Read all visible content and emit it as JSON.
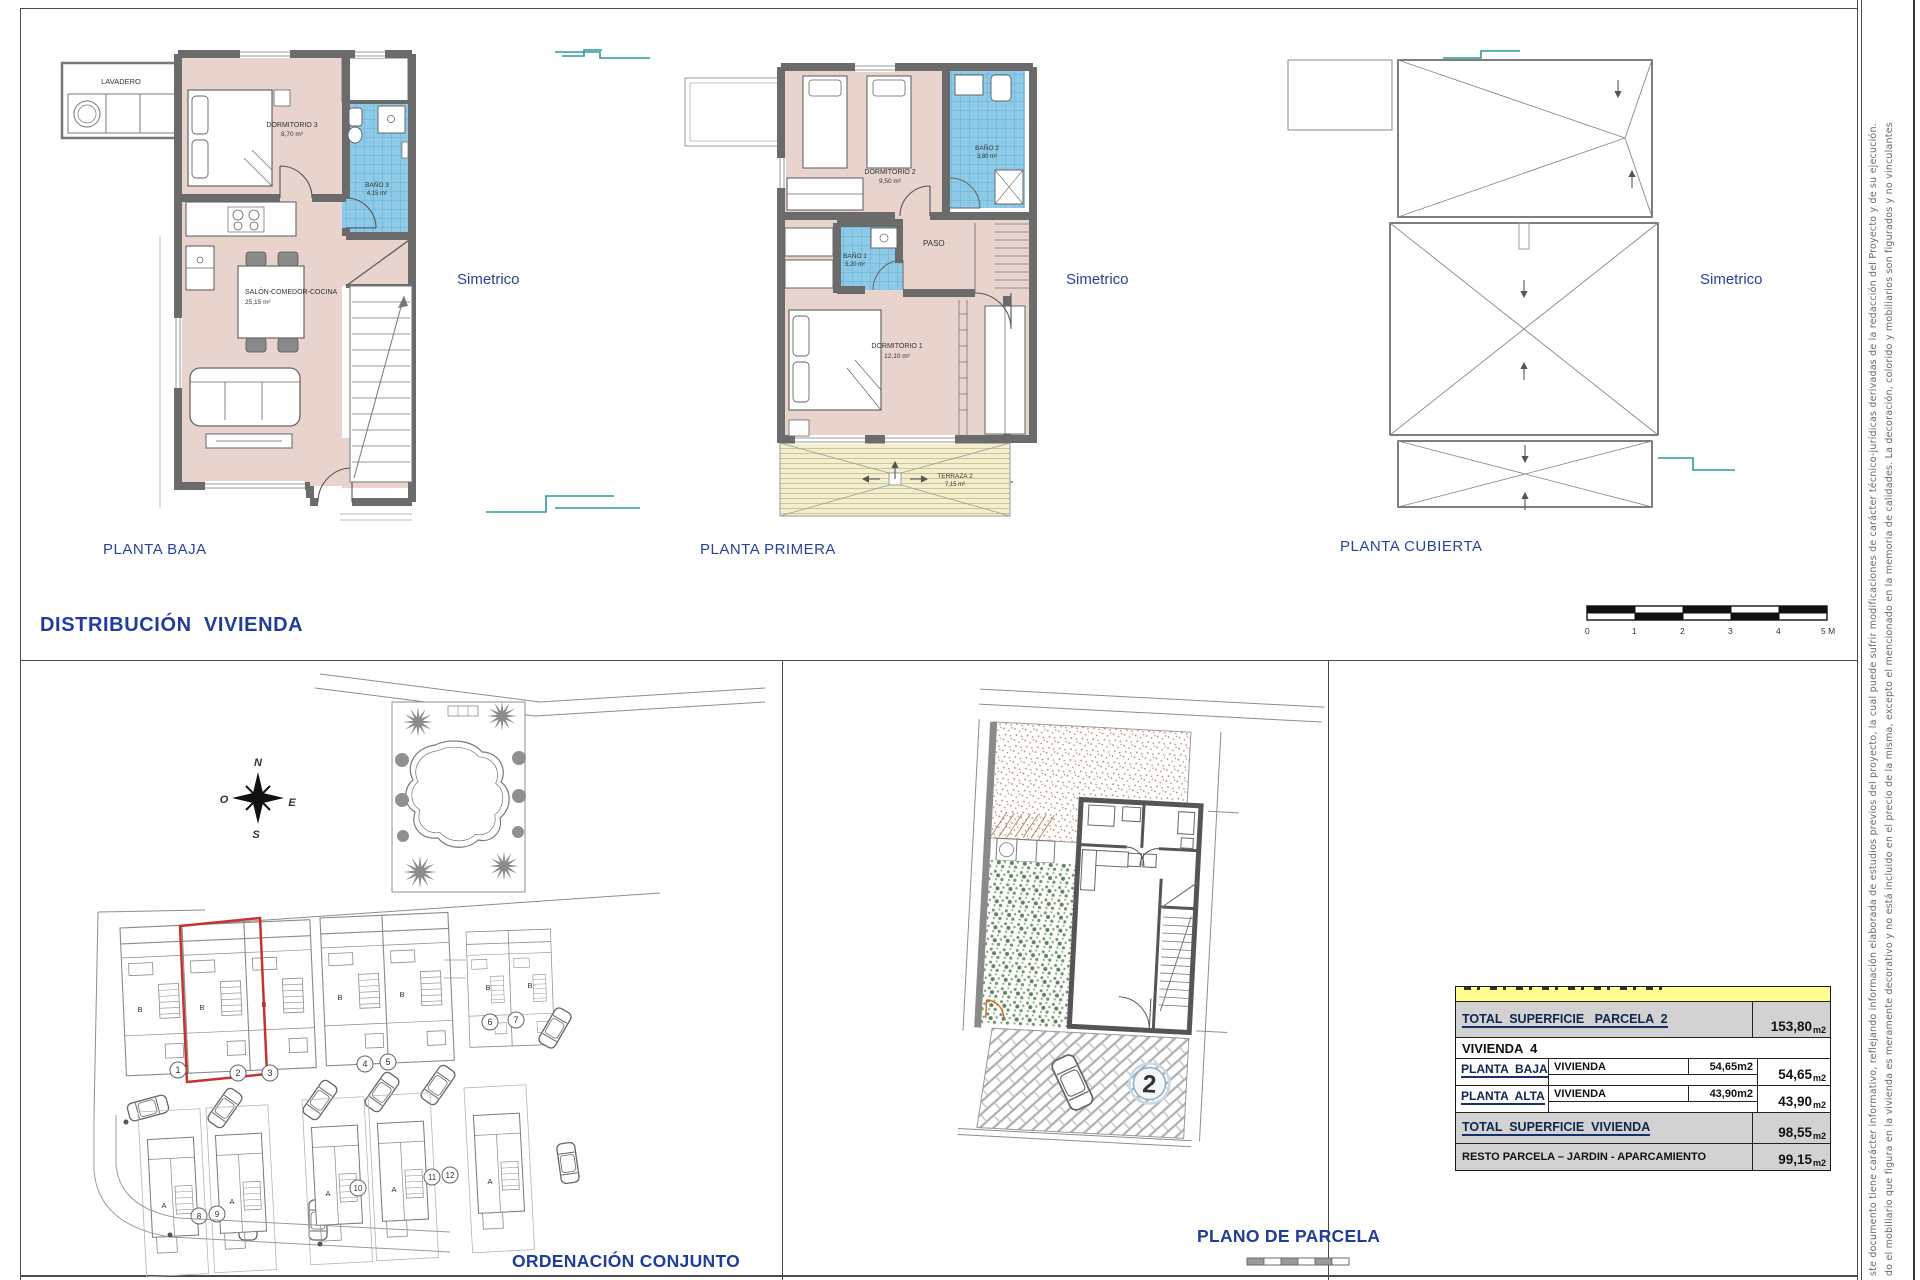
{
  "sheet_title": "DISTRIBUCIÓN  VIVIENDA",
  "plans": {
    "baja": {
      "title": "PLANTA BAJA",
      "simetrico": "Simetrico",
      "lavadero": "LAVADERO",
      "dormitorio3_name": "DORMITORIO 3",
      "dormitorio3_area": "8,70 m²",
      "bano3_name": "BAÑO 3",
      "bano3_area": "4,15 m²",
      "salon_name": "SALÓN-COMEDOR-COCINA",
      "salon_area": "25,15 m²"
    },
    "primera": {
      "title": "PLANTA PRIMERA",
      "simetrico": "Simetrico",
      "dormitorio2_name": "DORMITORIO 2",
      "dormitorio2_area": "9,50 m²",
      "bano2_name": "BAÑO 2",
      "bano2_area": "3,80 m²",
      "bano1_name": "BAÑO 1",
      "bano1_area": "3,20 m²",
      "paso": "PASO",
      "dormitorio1_name": "DORMITORIO 1",
      "dormitorio1_area": "12,10 m²",
      "terraza_name": "TERRAZA 2",
      "terraza_area": "7,15 m²"
    },
    "cubierta": {
      "title": "PLANTA CUBIERTA",
      "simetrico": "Simetrico"
    }
  },
  "scale_bar": {
    "ticks": [
      "0",
      "1",
      "2",
      "3",
      "4",
      "5 M"
    ]
  },
  "site_plan": {
    "title": "ORDENACIÓN CONJUNTO",
    "compass": {
      "n": "N",
      "e": "E",
      "s": "S",
      "w": "O"
    },
    "plots_upper": [
      "1",
      "2",
      "3",
      "4",
      "5",
      "6",
      "7"
    ],
    "plots_lower": [
      "8",
      "9",
      "10",
      "11",
      "12"
    ],
    "unit_b": "B",
    "unit_a": "A"
  },
  "parcel_plan": {
    "title": "PLANO DE PARCELA",
    "parcel_number": "2"
  },
  "area_table": {
    "total_parcela": {
      "label": "TOTAL  SUPERFICIE   PARCELA  2",
      "num": "153,80",
      "unit": "m2"
    },
    "vivienda_header": "VIVIENDA  4",
    "planta_baja": {
      "label": "PLANTA  BAJA",
      "concept": "VIVIENDA",
      "partial": "54,65m2",
      "num": "54,65",
      "unit": "m2"
    },
    "planta_alta": {
      "label": "PLANTA  ALTA",
      "concept": "VIVIENDA",
      "partial": "43,90m2",
      "num": "43,90",
      "unit": "m2"
    },
    "total_vivienda": {
      "label": "TOTAL  SUPERFICIE  VIVIENDA",
      "num": "98,55",
      "unit": "m2"
    },
    "resto": {
      "label": "RESTO PARCELA – JARDIN - APARCAMIENTO",
      "num": "99,15",
      "unit": "m2"
    }
  },
  "disclaimer": {
    "line1": "ste documento tiene carácter informativo, reflejando información elaborada de estudios previos del proyecto, la cual puede sufrir modificaciones de carácter técnico-jurídicas derivadas de la redacción del Proyecto y de su ejecución.",
    "line2": "do el mobiliario que figura en la vivienda es meramente decorativo y no está incluido en el precio de la misma, excepto el mencionado en la memoria de calidades. La decoración, colorido y mobiliarios son figurados y no vinculantes"
  },
  "colors": {
    "label_blue": "#1f3d9b",
    "floor_pink": "#e8d3cd",
    "bath_blue": "#8dcae8",
    "wall_gray": "#6b6b6b",
    "terrace_cream": "#f3eecd",
    "table_gray": "#d2d2d2",
    "table_yellow": "#ffff8f",
    "highlight_red": "#c4342c",
    "tick_teal": "#2e9b9b"
  }
}
